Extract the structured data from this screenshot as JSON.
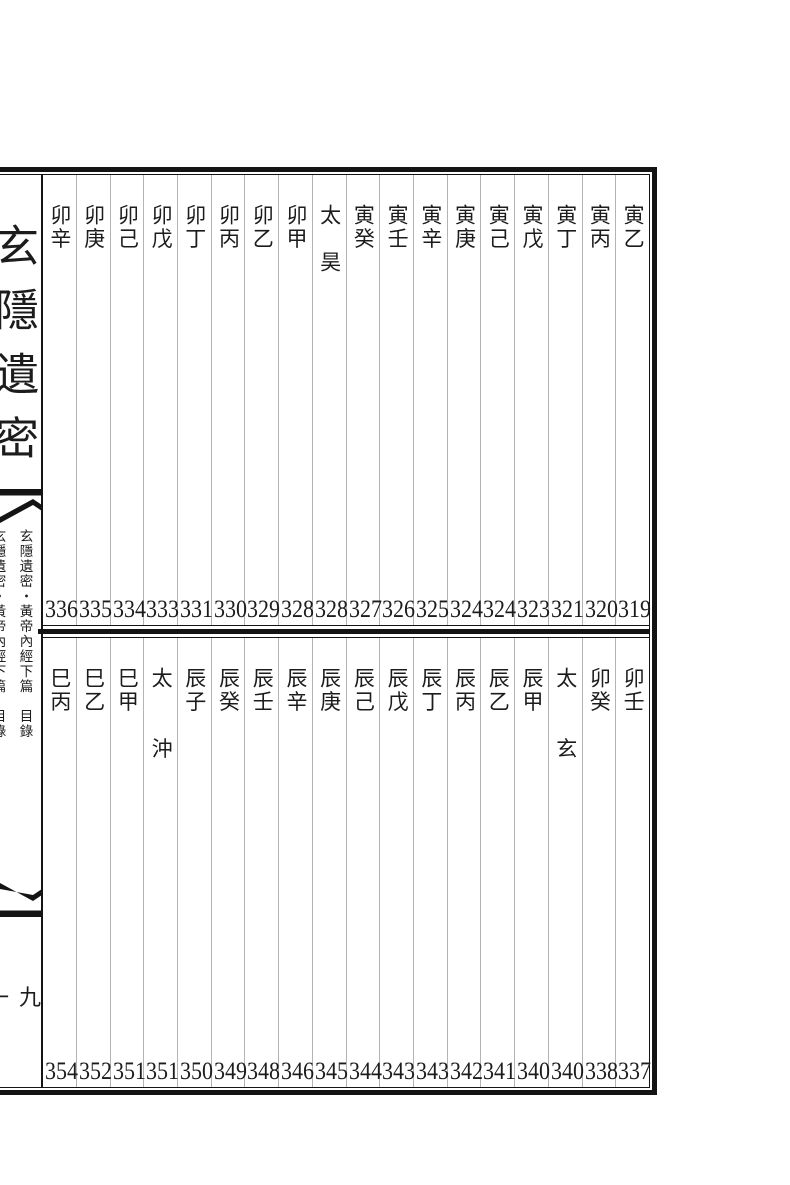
{
  "meta": {
    "page_bg": "#ffffff",
    "ink_color": "#1c1c1c",
    "frame_color": "#141414",
    "grid_line_color": "#b4b4b4"
  },
  "spine": {
    "main_title": "玄隱遺密",
    "running_title": "玄隱遺密・黃帝內經下篇　目錄",
    "running_title_left_partial": "玄隱遺密・黃帝內經下篇　目錄",
    "folio_number": "一九",
    "fishtail_top_icon": "fishtail-ornament-down",
    "fishtail_bottom_icon": "fishtail-ornament-up"
  },
  "upper_section": {
    "reading_order": "right-to-left",
    "entries": [
      {
        "label": "寅乙",
        "page": "319"
      },
      {
        "label": "寅丙",
        "page": "320"
      },
      {
        "label": "寅丁",
        "page": "321"
      },
      {
        "label": "寅戊",
        "page": "323"
      },
      {
        "label": "寅己",
        "page": "324"
      },
      {
        "label": "寅庚",
        "page": "324"
      },
      {
        "label": "寅辛",
        "page": "325"
      },
      {
        "label": "寅壬",
        "page": "326"
      },
      {
        "label": "寅癸",
        "page": "327"
      },
      {
        "label": "太　昊",
        "page": "328"
      },
      {
        "label": "卯甲",
        "page": "328"
      },
      {
        "label": "卯乙",
        "page": "329"
      },
      {
        "label": "卯丙",
        "page": "330"
      },
      {
        "label": "卯丁",
        "page": "331"
      },
      {
        "label": "卯戊",
        "page": "333"
      },
      {
        "label": "卯己",
        "page": "334"
      },
      {
        "label": "卯庚",
        "page": "335"
      },
      {
        "label": "卯辛",
        "page": "336"
      }
    ]
  },
  "lower_section": {
    "reading_order": "right-to-left",
    "entries": [
      {
        "label": "卯壬",
        "page": "337"
      },
      {
        "label": "卯癸",
        "page": "338"
      },
      {
        "label": "太　　玄",
        "page": "340"
      },
      {
        "label": "辰甲",
        "page": "340"
      },
      {
        "label": "辰乙",
        "page": "341"
      },
      {
        "label": "辰丙",
        "page": "342"
      },
      {
        "label": "辰丁",
        "page": "343"
      },
      {
        "label": "辰戊",
        "page": "343"
      },
      {
        "label": "辰己",
        "page": "344"
      },
      {
        "label": "辰庚",
        "page": "345"
      },
      {
        "label": "辰辛",
        "page": "346"
      },
      {
        "label": "辰壬",
        "page": "348"
      },
      {
        "label": "辰癸",
        "page": "349"
      },
      {
        "label": "辰子",
        "page": "350"
      },
      {
        "label": "太　　沖",
        "page": "351"
      },
      {
        "label": "巳甲",
        "page": "351"
      },
      {
        "label": "巳乙",
        "page": "352"
      },
      {
        "label": "巳丙",
        "page": "354"
      }
    ]
  }
}
